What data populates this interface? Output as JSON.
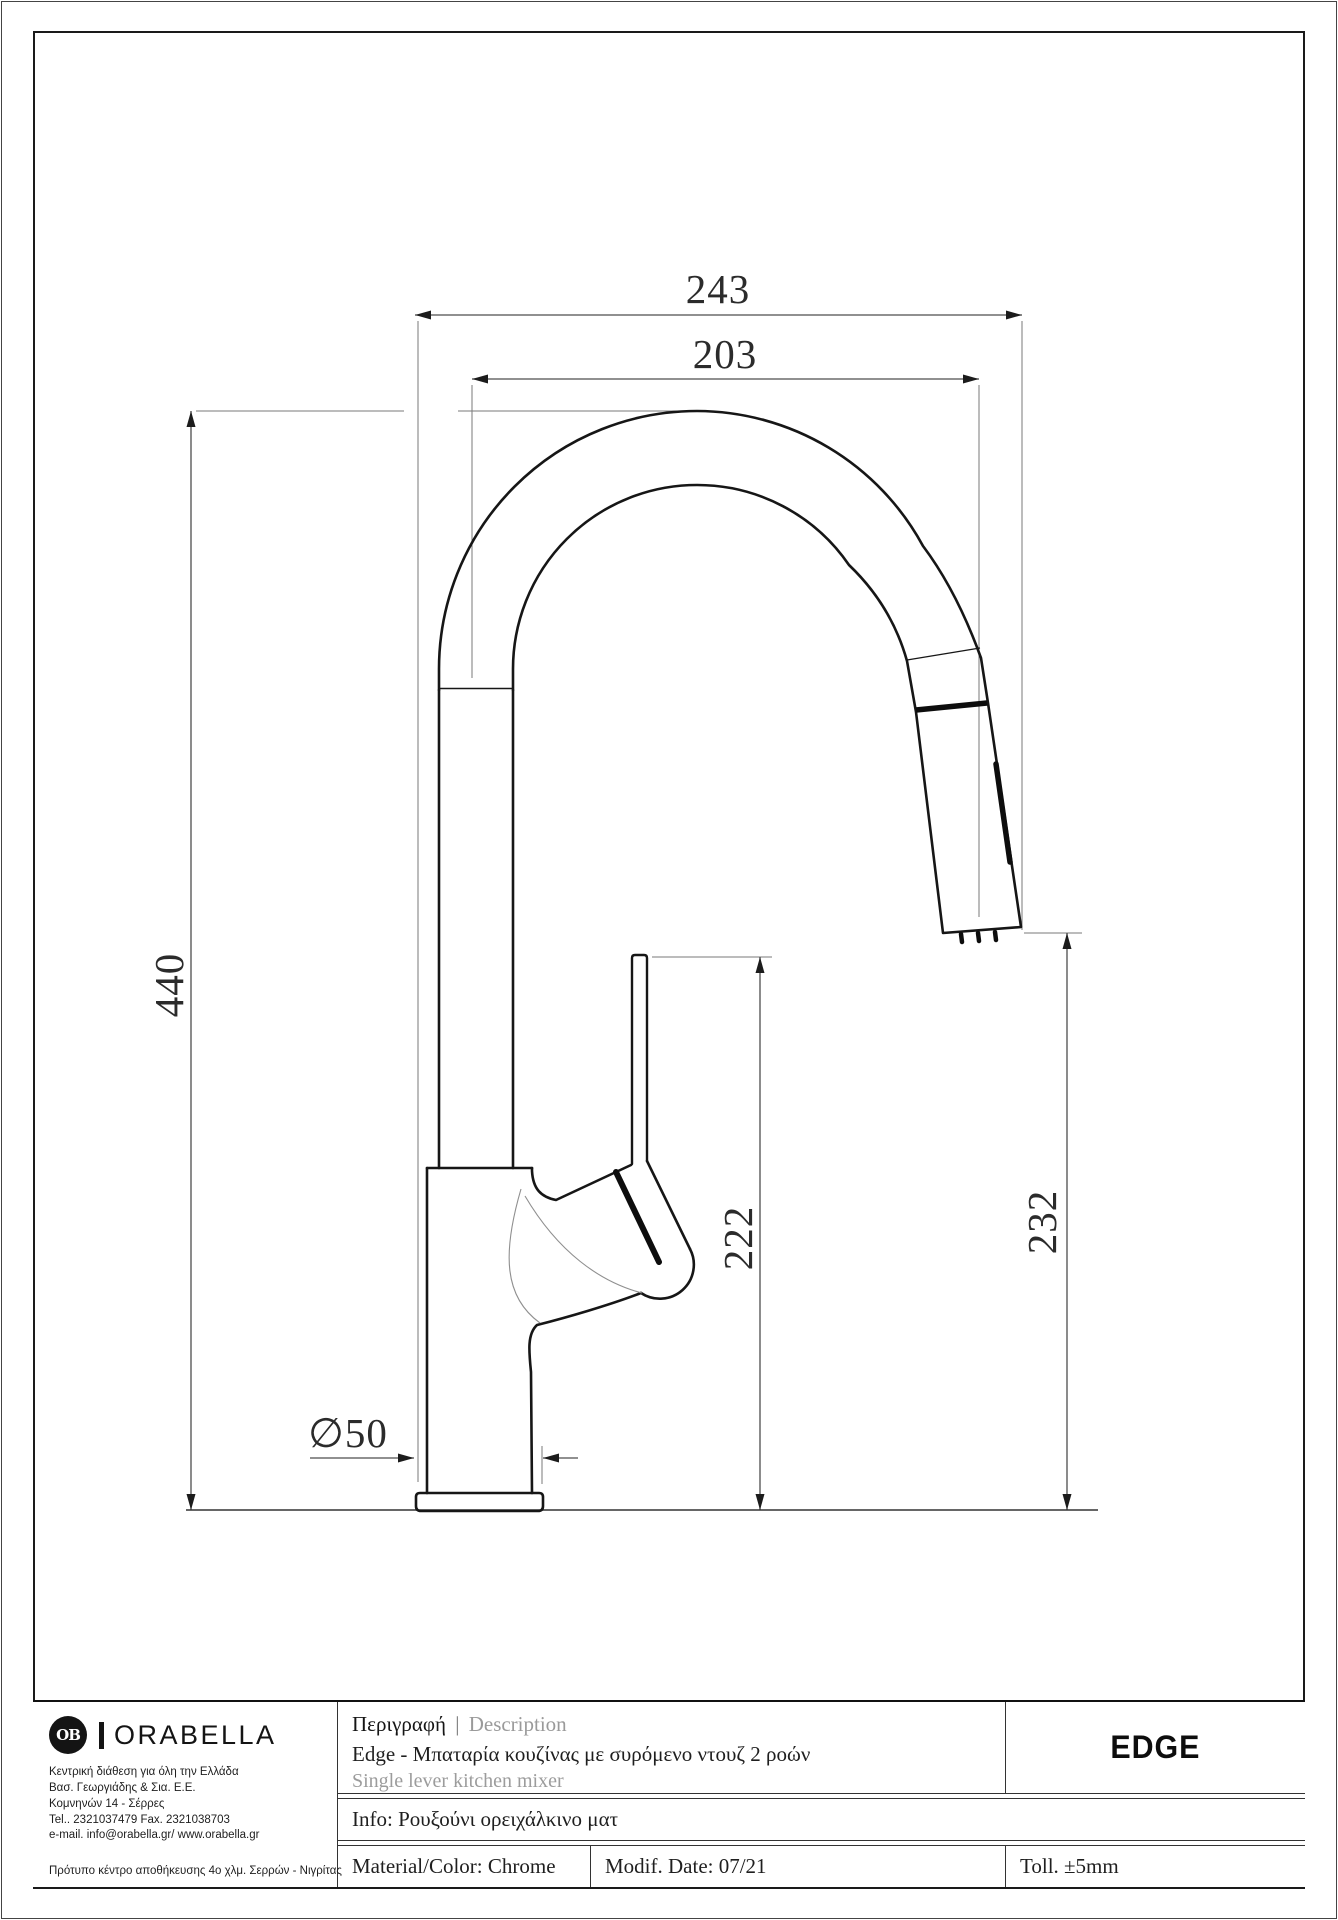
{
  "drawing": {
    "dimensions": {
      "overall_width": "243",
      "spout_reach": "203",
      "total_height": "440",
      "handle_height": "222",
      "spray_head_height": "232",
      "base_diameter": "∅50"
    }
  },
  "title_block": {
    "description_label_gr": "Περιγραφή",
    "separator": "|",
    "description_label_en": "Description",
    "description_gr": "Edge - Μπαταρία κουζίνας με συρόμενο ντουζ 2 ροών",
    "description_en": "Single lever kitchen mixer",
    "info": "Info: Ρουξούνι ορειχάλκινο ματ",
    "material": "Material/Color: Chrome",
    "modif_date": "Modif. Date: 07/21",
    "tolerance": "Toll. ±5mm",
    "product_code": "EDGE"
  },
  "company": {
    "logo_monogram": "OB",
    "logo_text": "ORABELLA",
    "address_lines": [
      "Κεντρική διάθεση για όλη την Ελλάδα",
      "Βασ. Γεωργιάδης & Σια. Ε.Ε.",
      "Κομνηνών 14 - Σέρρες",
      "Tel.. 2321037479 Fax. 2321038703",
      "e-mail. info@orabella.gr/ www.orabella.gr"
    ],
    "footer_line": "Πρότυπο κέντρο αποθήκευσης 4ο χλμ. Σερρών - Νιγρίτας"
  },
  "colors": {
    "outline": "#1a1a1a",
    "dimension_line": "#4d4d4d",
    "muted_text": "#9a9a9a",
    "background": "#ffffff"
  }
}
